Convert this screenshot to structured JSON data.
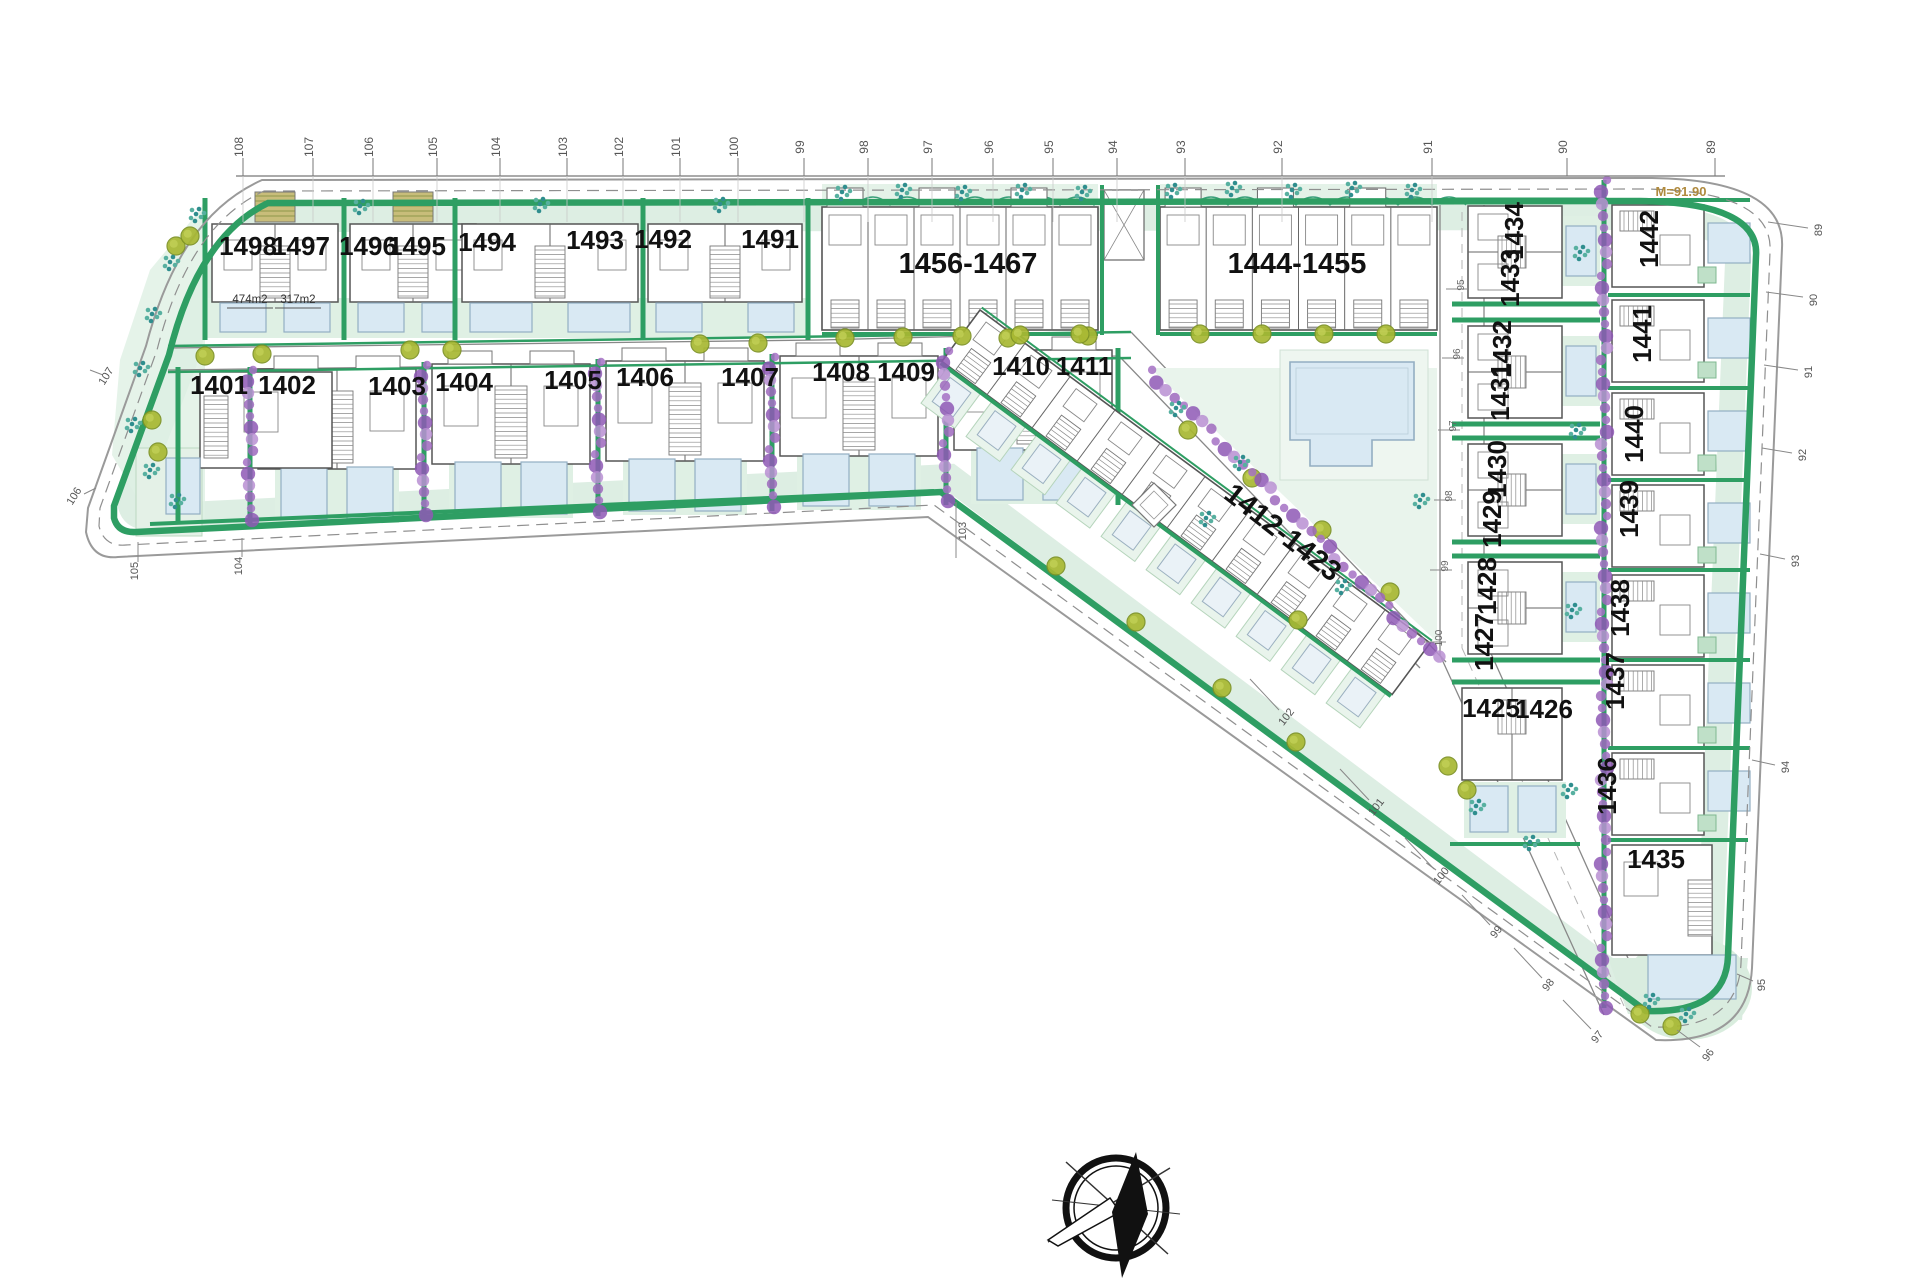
{
  "meta": {
    "kind": "residential-site-plan",
    "orientation_compass": true
  },
  "colors": {
    "green": "#2e9e63",
    "green_dark": "#1f7a49",
    "light_green": "#dff0e4",
    "lighter_green": "#e9f4ec",
    "lawn": "#e4f1e7",
    "pool": "#d9e9f3",
    "pool_border": "#93aec2",
    "purple": "#a06cc0",
    "olive": "#a8b832",
    "olive_ring": "#7d9226",
    "teal": "#2f8e8e",
    "line": "#555555",
    "boundary": "#9a9a9a",
    "tick": "#555555",
    "accent_note": "#b08a3e",
    "stair": "#777777"
  },
  "top_ruler": {
    "y_line": 176,
    "labels": [
      {
        "t": "108",
        "x": 243
      },
      {
        "t": "107",
        "x": 313
      },
      {
        "t": "106",
        "x": 373
      },
      {
        "t": "105",
        "x": 437
      },
      {
        "t": "104",
        "x": 500
      },
      {
        "t": "103",
        "x": 567
      },
      {
        "t": "102",
        "x": 623
      },
      {
        "t": "101",
        "x": 680
      },
      {
        "t": "100",
        "x": 738
      },
      {
        "t": "99",
        "x": 804
      },
      {
        "t": "98",
        "x": 868
      },
      {
        "t": "97",
        "x": 932
      },
      {
        "t": "96",
        "x": 993
      },
      {
        "t": "95",
        "x": 1053
      },
      {
        "t": "94",
        "x": 1117
      },
      {
        "t": "93",
        "x": 1185
      },
      {
        "t": "92",
        "x": 1282
      },
      {
        "t": "91",
        "x": 1432
      },
      {
        "t": "90",
        "x": 1567
      },
      {
        "t": "89",
        "x": 1715
      }
    ]
  },
  "edge_ticks": [
    {
      "t": "89",
      "x": 1822,
      "y": 230,
      "r": -90,
      "l": [
        1768,
        222,
        1808,
        228
      ]
    },
    {
      "t": "90",
      "x": 1817,
      "y": 300,
      "r": -90,
      "l": [
        1766,
        292,
        1803,
        297
      ]
    },
    {
      "t": "91",
      "x": 1812,
      "y": 372,
      "r": -90,
      "l": [
        1764,
        365,
        1798,
        370
      ]
    },
    {
      "t": "92",
      "x": 1806,
      "y": 455,
      "r": -90,
      "l": [
        1762,
        448,
        1792,
        453
      ]
    },
    {
      "t": "93",
      "x": 1799,
      "y": 561,
      "r": -90,
      "l": [
        1760,
        554,
        1785,
        559
      ]
    },
    {
      "t": "94",
      "x": 1789,
      "y": 767,
      "r": -90,
      "l": [
        1752,
        760,
        1775,
        765
      ]
    },
    {
      "t": "95",
      "x": 1765,
      "y": 985,
      "r": -90,
      "l": [
        1737,
        974,
        1753,
        981
      ]
    },
    {
      "t": "96",
      "x": 1711,
      "y": 1057,
      "r": -55,
      "l": [
        1677,
        1030,
        1700,
        1047
      ]
    },
    {
      "t": "97",
      "x": 1600,
      "y": 1039,
      "r": -52,
      "l": [
        1563,
        1000,
        1591,
        1029
      ]
    },
    {
      "t": "98",
      "x": 1551,
      "y": 987,
      "r": -52,
      "l": [
        1514,
        948,
        1542,
        978
      ]
    },
    {
      "t": "99",
      "x": 1499,
      "y": 934,
      "r": -52,
      "l": [
        1462,
        895,
        1490,
        925
      ]
    },
    {
      "t": "100",
      "x": 1444,
      "y": 878,
      "r": -52,
      "l": [
        1405,
        838,
        1434,
        869
      ]
    },
    {
      "t": "101",
      "x": 1379,
      "y": 809,
      "r": -52,
      "l": [
        1340,
        769,
        1369,
        800
      ]
    },
    {
      "t": "102",
      "x": 1289,
      "y": 719,
      "r": -52,
      "l": [
        1250,
        679,
        1279,
        710
      ]
    },
    {
      "t": "103",
      "x": 966,
      "y": 531,
      "r": -90,
      "l": [
        956,
        502,
        956,
        558
      ]
    },
    {
      "t": "104",
      "x": 242,
      "y": 566,
      "r": -90,
      "l": [
        242,
        538,
        242,
        557
      ]
    },
    {
      "t": "105",
      "x": 138,
      "y": 571,
      "r": -90,
      "l": [
        138,
        542,
        138,
        562
      ]
    },
    {
      "t": "106",
      "x": 77,
      "y": 498,
      "r": -58,
      "l": [
        96,
        488,
        84,
        494
      ]
    },
    {
      "t": "107",
      "x": 109,
      "y": 378,
      "r": -58,
      "l": [
        90,
        370,
        103,
        375
      ]
    }
  ],
  "road_ticks": [
    {
      "t": "95",
      "x": 1458,
      "y": 289
    },
    {
      "t": "96",
      "x": 1454,
      "y": 358
    },
    {
      "t": "97",
      "x": 1450,
      "y": 430
    },
    {
      "t": "98",
      "x": 1446,
      "y": 500
    },
    {
      "t": "99",
      "x": 1442,
      "y": 570
    },
    {
      "t": "100",
      "x": 1436,
      "y": 642
    }
  ],
  "plots": {
    "row1": [
      {
        "t": "1498",
        "x": 248,
        "y": 255
      },
      {
        "t": "1497",
        "x": 301,
        "y": 255
      },
      {
        "t": "1496",
        "x": 368,
        "y": 255
      },
      {
        "t": "1495",
        "x": 417,
        "y": 255
      },
      {
        "t": "1494",
        "x": 487,
        "y": 251
      },
      {
        "t": "1493",
        "x": 595,
        "y": 249
      },
      {
        "t": "1492",
        "x": 663,
        "y": 248
      },
      {
        "t": "1491",
        "x": 770,
        "y": 248
      }
    ],
    "row2": [
      {
        "t": "1401",
        "x": 219,
        "y": 394
      },
      {
        "t": "1402",
        "x": 287,
        "y": 394
      },
      {
        "t": "1403",
        "x": 397,
        "y": 395
      },
      {
        "t": "1404",
        "x": 464,
        "y": 391
      },
      {
        "t": "1405",
        "x": 573,
        "y": 389
      },
      {
        "t": "1406",
        "x": 645,
        "y": 386
      },
      {
        "t": "1407",
        "x": 750,
        "y": 386
      },
      {
        "t": "1408",
        "x": 841,
        "y": 381
      },
      {
        "t": "1409",
        "x": 906,
        "y": 381
      },
      {
        "t": "1410",
        "x": 1021,
        "y": 375
      },
      {
        "t": "1411",
        "x": 1084,
        "y": 375
      }
    ],
    "blocks": [
      {
        "t": "1456-1467",
        "x": 968,
        "y": 273,
        "r": 0
      },
      {
        "t": "1444-1455",
        "x": 1297,
        "y": 273,
        "r": 0
      },
      {
        "t": "1412-1423",
        "x": 1277,
        "y": 540,
        "r": 38
      }
    ],
    "col_inner": [
      {
        "t": "1434",
        "x": 1523,
        "y": 231,
        "r": -90
      },
      {
        "t": "1433",
        "x": 1519,
        "y": 278,
        "r": -90
      },
      {
        "t": "1432",
        "x": 1511,
        "y": 349,
        "r": -90
      },
      {
        "t": "1431",
        "x": 1509,
        "y": 392,
        "r": -90
      },
      {
        "t": "1430",
        "x": 1506,
        "y": 469,
        "r": -90
      },
      {
        "t": "1429",
        "x": 1501,
        "y": 519,
        "r": -90
      },
      {
        "t": "1428",
        "x": 1496,
        "y": 586,
        "r": -90
      },
      {
        "t": "1427",
        "x": 1493,
        "y": 642,
        "r": -90
      },
      {
        "t": "1425",
        "x": 1491,
        "y": 717,
        "r": 0
      },
      {
        "t": "1426",
        "x": 1544,
        "y": 718,
        "r": 0
      }
    ],
    "col_outer": [
      {
        "t": "1442",
        "x": 1658,
        "y": 239,
        "r": -90
      },
      {
        "t": "1441",
        "x": 1651,
        "y": 334,
        "r": -90
      },
      {
        "t": "1440",
        "x": 1643,
        "y": 434,
        "r": -90
      },
      {
        "t": "1439",
        "x": 1638,
        "y": 509,
        "r": -90
      },
      {
        "t": "1438",
        "x": 1629,
        "y": 608,
        "r": -90
      },
      {
        "t": "1437",
        "x": 1624,
        "y": 681,
        "r": -90
      },
      {
        "t": "1436",
        "x": 1616,
        "y": 786,
        "r": -90
      },
      {
        "t": "1435",
        "x": 1656,
        "y": 868,
        "r": 0
      }
    ]
  },
  "area_labels": [
    {
      "t": "474m2",
      "x": 250,
      "y": 303
    },
    {
      "t": "317m2",
      "x": 298,
      "y": 303
    }
  ],
  "annotations": [
    {
      "t": "M=91.90",
      "x": 1681,
      "y": 196
    }
  ]
}
